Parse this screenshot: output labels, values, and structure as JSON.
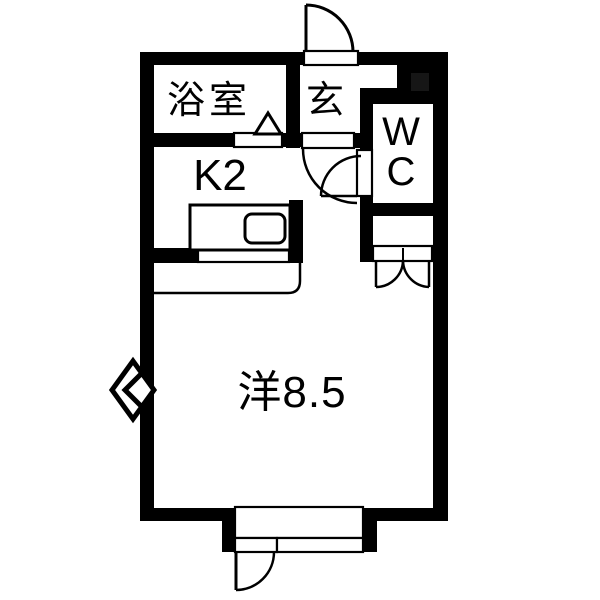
{
  "title": "floor-plan",
  "colors": {
    "wall": "#000000",
    "background": "#ffffff",
    "pillar_accent": "#161616",
    "line": "#000000"
  },
  "rooms": {
    "bathroom": {
      "label": "浴室"
    },
    "entrance": {
      "label": "玄"
    },
    "toilet": {
      "line1": "W",
      "line2": "C"
    },
    "kitchen": {
      "label": "K2"
    },
    "main_room": {
      "label": "洋8.5"
    }
  },
  "symbols": [
    "entrance-door-swing",
    "hall-door-swing",
    "wc-door-swing",
    "closet-double-door",
    "balcony-door-swing",
    "bathroom-door-triangle",
    "window-diamond",
    "kitchen-counter",
    "kitchen-sink",
    "kitchen-pass-through-window"
  ]
}
